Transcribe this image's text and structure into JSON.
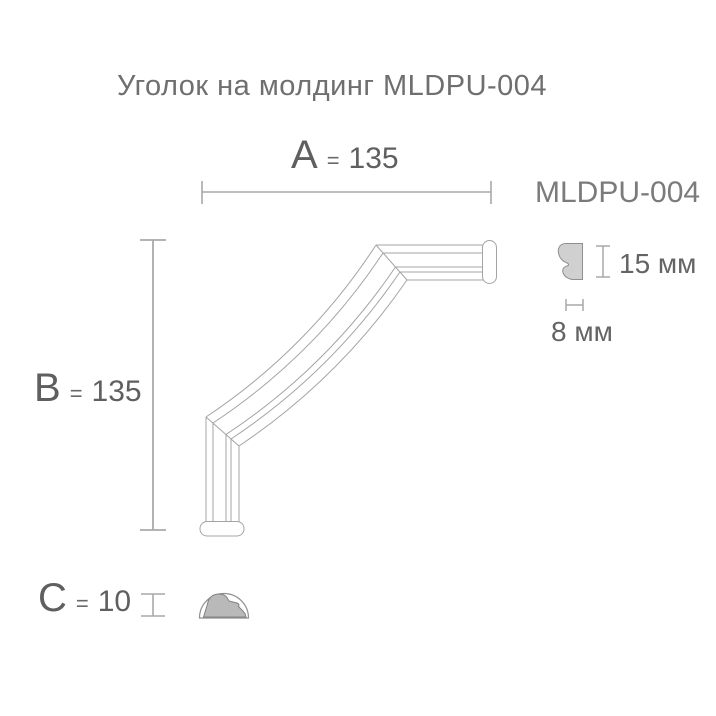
{
  "title": "Уголок на молдинг MLDPU-004",
  "product_label": "MLDPU-004",
  "dimensions": {
    "a": {
      "letter": "A",
      "equals": "=",
      "value": "135"
    },
    "b": {
      "letter": "B",
      "equals": "=",
      "value": "135"
    },
    "c": {
      "letter": "C",
      "equals": "=",
      "value": "10"
    }
  },
  "profile": {
    "height": "15 мм",
    "width": "8 мм"
  },
  "colors": {
    "title_text": "#6f6f6f",
    "dimension_text": "#5f5f5f",
    "product_text": "#7b7b7b",
    "dimension_lines": "#a9a9a9",
    "molding_outline": "#a4a4a4",
    "profile_fill": "#d0d0d0",
    "end_profile_fill": "#b9b9b9",
    "background": "#ffffff"
  }
}
